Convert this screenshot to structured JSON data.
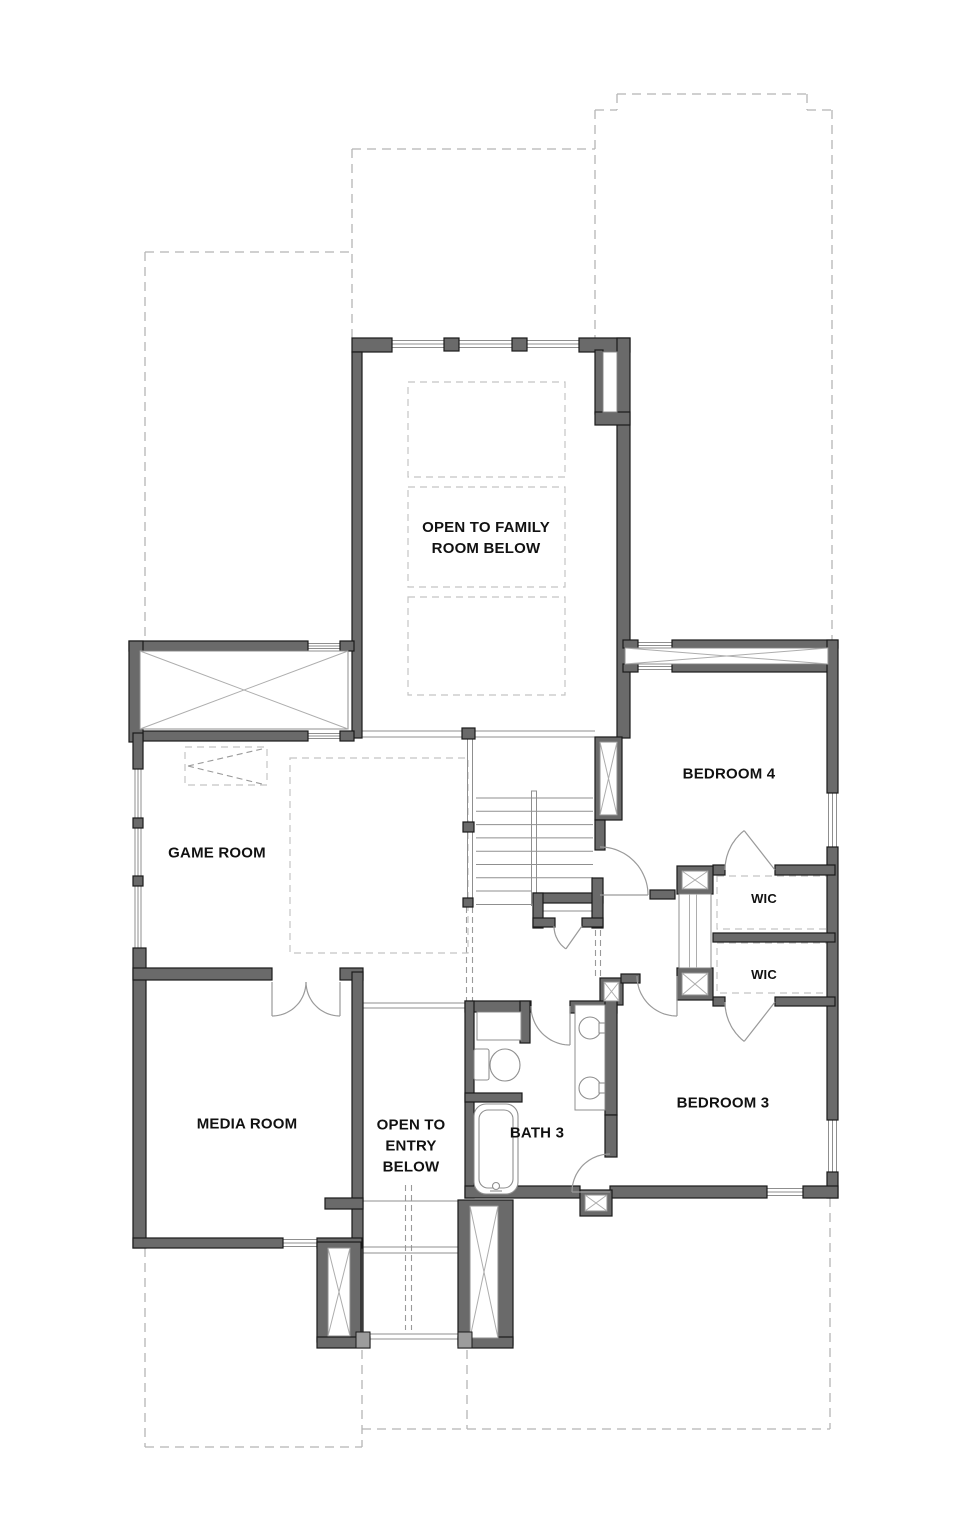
{
  "colors": {
    "background": "#ffffff",
    "wall_fill": "#6a6a6a",
    "wall_edge": "#1a1a1a",
    "thin_line": "#8f8f8f",
    "roof_dashed_line": "#b5b5b5",
    "interior_dashed_line": "#c4c4c4",
    "door_swing_line": "#9a9a9a",
    "x_brace_line": "#adadad",
    "sill_fill": "#9c9c9c",
    "label_text": "#111111"
  },
  "labels": [
    {
      "id": "open-to-family-room",
      "label": "OPEN TO FAMILY\nROOM BELOW",
      "x": 486,
      "y": 538
    },
    {
      "id": "game-room",
      "label": "GAME ROOM",
      "x": 217,
      "y": 853
    },
    {
      "id": "bedroom-4",
      "label": "BEDROOM 4",
      "x": 729,
      "y": 774
    },
    {
      "id": "wic-upper",
      "label": "WIC",
      "x": 764,
      "y": 899
    },
    {
      "id": "wic-lower",
      "label": "WIC",
      "x": 764,
      "y": 975
    },
    {
      "id": "media-room",
      "label": "MEDIA ROOM",
      "x": 247,
      "y": 1124
    },
    {
      "id": "open-to-entry",
      "label": "OPEN TO\nENTRY\nBELOW",
      "x": 411,
      "y": 1146
    },
    {
      "id": "bath-3",
      "label": "BATH 3",
      "x": 537,
      "y": 1133
    },
    {
      "id": "bedroom-3",
      "label": "BEDROOM 3",
      "x": 723,
      "y": 1103
    }
  ],
  "fixtures": [
    "staircase",
    "toilet",
    "bathtub",
    "double-vanity-sinks",
    "double-entry-doors",
    "swing-doors",
    "attic-chase-boxes",
    "porch-columns",
    "windows"
  ]
}
